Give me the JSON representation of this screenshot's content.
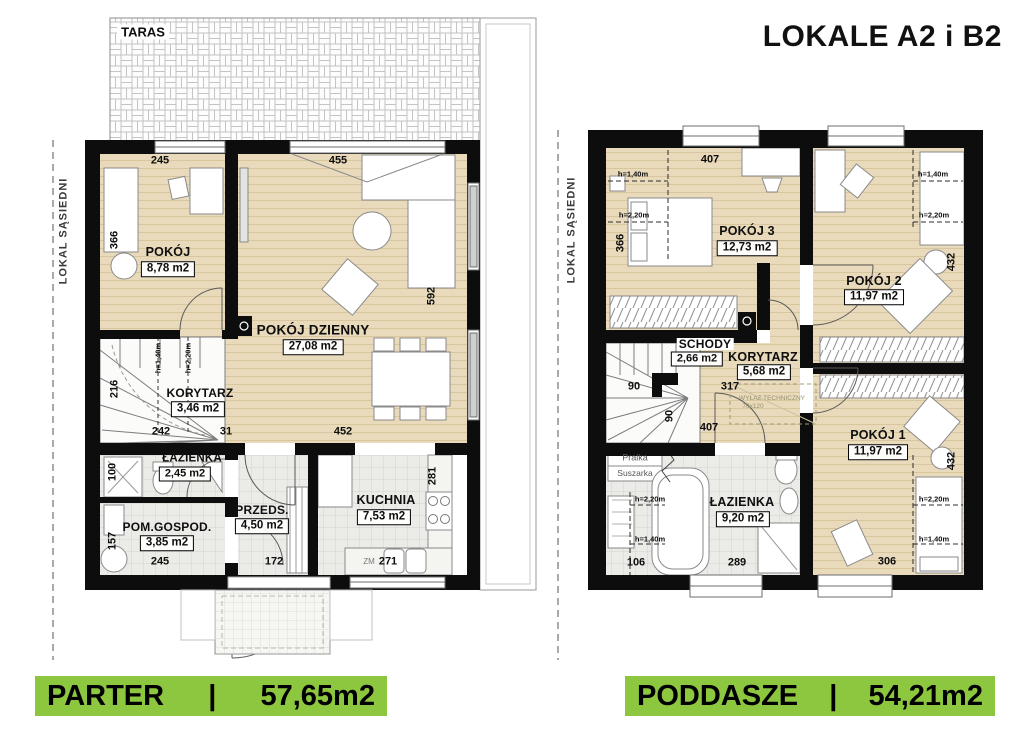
{
  "title": "LOKALE A2 i B2",
  "banners": {
    "parter": {
      "label": "PARTER",
      "sep": "|",
      "area": "57,65m2"
    },
    "poddasze": {
      "label": "PODDASZE",
      "sep": "|",
      "area": "54,21m2"
    }
  },
  "shared": {
    "neighbor": "LOKAL SĄSIEDNI"
  },
  "colors": {
    "accent_green": "#8dc63f",
    "floor_wood": "#e8dabb",
    "floor_tile": "#ebebe7",
    "wall": "#0d0d0d"
  },
  "parter": {
    "taras": "TARAS",
    "rooms": {
      "pokoj": {
        "name": "POKÓJ",
        "area": "8,78 m2"
      },
      "dzienny": {
        "name": "POKÓJ DZIENNY",
        "area": "27,08 m2"
      },
      "korytarz": {
        "name": "KORYTARZ",
        "area": "3,46 m2"
      },
      "lazienka": {
        "name": "ŁAZIENKA",
        "area": "2,45 m2"
      },
      "gospod": {
        "name": "POM.GOSPOD.",
        "area": "3,85 m2"
      },
      "przeds": {
        "name": "PRZEDS.",
        "area": "4,50 m2"
      },
      "kuchnia": {
        "name": "KUCHNIA",
        "area": "7,53 m2"
      }
    },
    "dims": {
      "d245t": "245",
      "d455": "455",
      "d366": "366",
      "d592": "592",
      "d216": "216",
      "d242": "242",
      "d31": "31",
      "d452": "452",
      "d100": "100",
      "d157": "157",
      "d245b": "245",
      "d172": "172",
      "d271": "271",
      "d281": "281",
      "zm": "ZM"
    },
    "heights": {
      "h140": "h=1,40m",
      "h220": "h=2,20m"
    }
  },
  "poddasze": {
    "rooms": {
      "pokoj3": {
        "name": "POKÓJ 3",
        "area": "12,73 m2"
      },
      "pokoj2": {
        "name": "POKÓJ 2",
        "area": "11,97 m2"
      },
      "pokoj1": {
        "name": "POKÓJ 1",
        "area": "11,97 m2"
      },
      "schody": {
        "name": "SCHODY",
        "area": "2,66 m2"
      },
      "korytarz": {
        "name": "KORYTARZ",
        "area": "5,68 m2"
      },
      "lazienka": {
        "name": "ŁAZIENKA",
        "area": "9,20 m2"
      }
    },
    "dims": {
      "d407t": "407",
      "d366": "366",
      "d432a": "432",
      "d432b": "432",
      "d90a": "90",
      "d317": "317",
      "d90b": "90",
      "d407b": "407",
      "d106": "106",
      "d289": "289",
      "d306": "306"
    },
    "heights": {
      "h140": "h=1,40m",
      "h220": "h=2,20m"
    },
    "labels": {
      "pralka": "Pralka",
      "suszarka": "Suszarka",
      "wylaz1": "WYŁAZ TECHNICZNY",
      "wylaz2": "70x120"
    }
  }
}
